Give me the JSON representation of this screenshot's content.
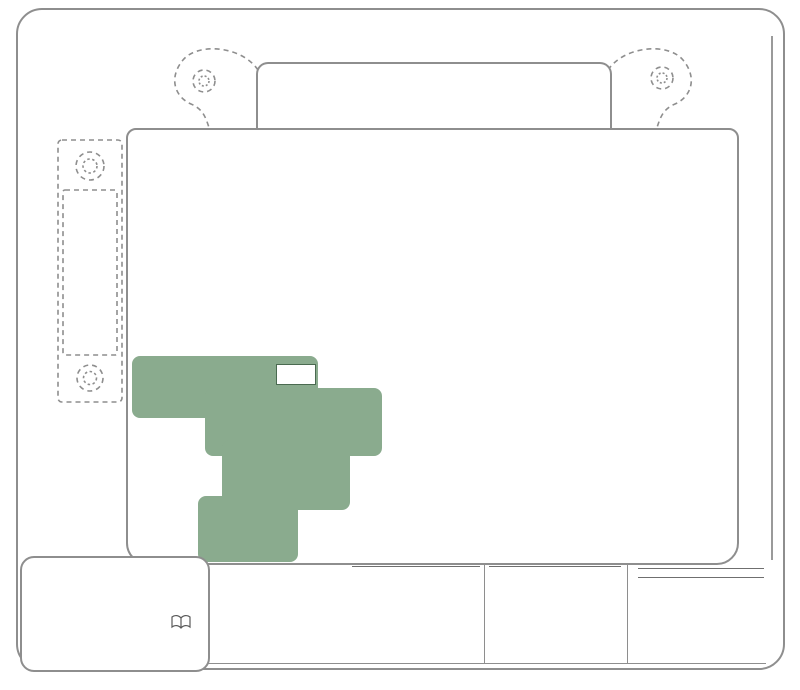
{
  "titles": {
    "en": "Replace cover after servicing.",
    "fr": "Remettre le couvercle en place."
  },
  "labels": {
    "b_plus": "B+",
    "prime": "PRIME",
    "function_line1": "FUNCTION [AMP]",
    "function_line2": "FONCTION [INTENSITÉ]"
  },
  "highlight_color": "#8aab8e",
  "left_block": {
    "lines": [
      "125A",
      "GLOW",
      "PLUG",
      "",
      "OR",
      "",
      "125A",
      "CUST",
      "FEED",
      "",
      "175A",
      "HYBRID"
    ]
  },
  "top_row1": [
    {
      "l1": "STUD",
      "l2": "#1*",
      "l3": "",
      "x": 262,
      "y": 69,
      "w": 54,
      "h": 56
    },
    {
      "l1": "MBEC",
      "l2": "1",
      "l3": "50A",
      "x": 370,
      "y": 69,
      "w": 54,
      "h": 56
    },
    {
      "l1": "BLWR",
      "l2": "",
      "l3": "40A",
      "x": 428,
      "y": 69,
      "w": 54,
      "h": 56
    },
    {
      "l1": "LBEC",
      "l2": "2",
      "l3": "50A",
      "x": 486,
      "y": 69,
      "w": 54,
      "h": 56
    },
    {
      "l1": "STUD",
      "l2": "#2*",
      "l3": "30A MAX",
      "x": 544,
      "y": 69,
      "w": 57,
      "h": 56
    }
  ],
  "top_row2": [
    {
      "l1": "ABS",
      "l2": "",
      "l3": "60A",
      "x": 250,
      "y": 134,
      "w": 56,
      "h": 54
    },
    {
      "l1": "VSES/",
      "l2": "ECAS",
      "l3": "50A",
      "x": 314,
      "y": 134,
      "w": 56,
      "h": 54
    },
    {
      "l1": "IGN",
      "l2": "A",
      "l3": "40A",
      "x": 372,
      "y": 134,
      "w": 56,
      "h": 54
    },
    {
      "l1": "IGN",
      "l2": "B",
      "l3": "40A",
      "x": 488,
      "y": 134,
      "w": 56,
      "h": 54
    },
    {
      "l1": "LBEC",
      "l2": "1",
      "l3": "50A",
      "x": 546,
      "y": 134,
      "w": 56,
      "h": 54
    }
  ],
  "panel": {
    "fuses": [
      {
        "label": "TRL PARK",
        "amp": "15A",
        "x": 140,
        "y": 225,
        "w": 64,
        "h": 24
      },
      {
        "label": "RR PARK",
        "amp": "10A",
        "x": 206,
        "y": 225,
        "w": 62,
        "h": 24
      },
      {
        "label": "LR PARK",
        "amp": "10A",
        "x": 258,
        "y": 225,
        "w": 58,
        "h": 24
      },
      {
        "label": "TBC BATT",
        "amp": "10A",
        "x": 168,
        "y": 256,
        "w": 66,
        "h": 24
      },
      {
        "label": "4WS",
        "amp": "15A",
        "x": 139,
        "y": 281,
        "w": 62,
        "h": 24
      },
      {
        "label": "INTPARK",
        "amp": "10A",
        "x": 512,
        "y": 226,
        "w": 66,
        "h": 24
      },
      {
        "label": "STOP LP",
        "amp": "25A",
        "x": 646,
        "y": 226,
        "w": 68,
        "h": 24
      },
      {
        "label": "SEO B2",
        "amp": "30A",
        "x": 630,
        "y": 251,
        "w": 60,
        "h": 24
      },
      {
        "label": "AUX PWR",
        "amp": "20A",
        "x": 574,
        "y": 279,
        "w": 60,
        "h": 24
      },
      {
        "label": "PCM 1",
        "amp": "15A",
        "x": 252,
        "y": 309,
        "w": 62,
        "h": 24
      },
      {
        "label": "ETC/ECM",
        "amp": "15A",
        "x": 317,
        "y": 309,
        "w": 70,
        "h": 24
      },
      {
        "label": "IGN E",
        "amp": "10A",
        "x": 497,
        "y": 311,
        "w": 60,
        "h": 24
      },
      {
        "label": "RTD",
        "amp": "30A",
        "x": 139,
        "y": 334,
        "w": 62,
        "h": 24
      },
      {
        "label": "TRL B/U",
        "amp": "10A",
        "x": 205,
        "y": 334,
        "w": 64,
        "h": 24
      },
      {
        "label": "B/U LP",
        "amp": "20A",
        "x": 464,
        "y": 336,
        "w": 60,
        "h": 24
      },
      {
        "label": "RR DEFOG",
        "amp": "30A",
        "x": 557,
        "y": 335,
        "w": 72,
        "h": 24
      },
      {
        "label": "AIRBAG",
        "amp": "15A",
        "x": 544,
        "y": 361,
        "w": 62,
        "h": 24
      },
      {
        "label": "SEO IGN",
        "amp": "10A",
        "x": 483,
        "y": 392,
        "w": 60,
        "h": 24
      },
      {
        "label": "TBC IGN1",
        "amp": "10A",
        "x": 544,
        "y": 392,
        "w": 64,
        "h": 24
      },
      {
        "label": "FRT PARK",
        "amp": "10A",
        "x": 227,
        "y": 391,
        "w": 64,
        "h": 25
      },
      {
        "label": "HI HDLP-LT",
        "amp": "10A",
        "x": 132,
        "y": 420,
        "w": 66,
        "h": 25
      },
      {
        "label": "LH HID",
        "amp": "20A",
        "x": 206,
        "y": 419,
        "w": 58,
        "h": 25
      },
      {
        "label": "DRL",
        "amp": "10A",
        "x": 376,
        "y": 419,
        "w": 54,
        "h": 24
      },
      {
        "label": "RVC",
        "amp": "10A",
        "x": 431,
        "y": 419,
        "w": 52,
        "h": 24
      },
      {
        "label": "IPC/DIC",
        "amp": "10A",
        "x": 485,
        "y": 418,
        "w": 56,
        "h": 24
      },
      {
        "label": "HVAC/ECAS",
        "amp": "10A",
        "x": 543,
        "y": 417,
        "w": 62,
        "h": 24
      },
      {
        "label": "CIG LTR",
        "amp": "15A",
        "x": 629,
        "y": 419,
        "w": 58,
        "h": 24
      },
      {
        "label": "HI HDLP-RT",
        "amp": "10A",
        "x": 132,
        "y": 451,
        "w": 66,
        "h": 25
      },
      {
        "label": "A/C COMP",
        "amp": "10A",
        "x": 428,
        "y": 447,
        "w": 58,
        "h": 23
      },
      {
        "label": "TCMB",
        "amp": "10A",
        "x": 488,
        "y": 447,
        "w": 54,
        "h": 23
      },
      {
        "label": "RR WPR",
        "amp": "25A",
        "x": 544,
        "y": 448,
        "w": 56,
        "h": 23
      },
      {
        "label": "RADIO",
        "amp": "15A",
        "x": 603,
        "y": 448,
        "w": 54,
        "h": 23
      },
      {
        "label": "SEO B1",
        "amp": "15A",
        "x": 660,
        "y": 448,
        "w": 56,
        "h": 23
      },
      {
        "label": "LO HDLP-LT",
        "amp": "10A",
        "x": 132,
        "y": 481,
        "w": 66,
        "h": 25
      },
      {
        "label": "BTSI",
        "amp": "10A",
        "x": 428,
        "y": 475,
        "w": 54,
        "h": 23
      },
      {
        "label": "CRNK",
        "amp": "10A",
        "x": 488,
        "y": 475,
        "w": 54,
        "h": 23
      },
      {
        "label": "LO HDLP-RT",
        "amp": "10A",
        "x": 132,
        "y": 511,
        "w": 66,
        "h": 25
      },
      {
        "label": "FOG LP",
        "amp": "15A",
        "x": 288,
        "y": 504,
        "w": 58,
        "h": 24
      },
      {
        "label": "W/S WASH",
        "amp": "15A",
        "x": 514,
        "y": 501,
        "w": 64,
        "h": 24
      },
      {
        "label": "INFO",
        "amp": "15A",
        "x": 601,
        "y": 501,
        "w": 58,
        "h": 24
      },
      {
        "label": "RADIO AMP",
        "amp": "30A",
        "x": 660,
        "y": 501,
        "w": 64,
        "h": 24
      },
      {
        "label": "RH HID",
        "amp": "20A",
        "x": 134,
        "y": 540,
        "w": 64,
        "h": 25
      },
      {
        "label": "HORN",
        "amp": "15A",
        "x": 288,
        "y": 534,
        "w": 58,
        "h": 24
      },
      {
        "label": "EAP",
        "amp": "15A",
        "x": 514,
        "y": 531,
        "w": 64,
        "h": 24
      },
      {
        "label": "TREC",
        "amp": "30A",
        "x": 601,
        "y": 531,
        "w": 58,
        "h": 24
      },
      {
        "label": "SBA",
        "amp": "15A",
        "x": 660,
        "y": 531,
        "w": 58,
        "h": 24
      }
    ],
    "relays": [
      {
        "label": "PARK LP",
        "pins": [
          "86",
          "30",
          "87",
          "85"
        ],
        "x": 318,
        "y": 225,
        "w": 84,
        "h": 64,
        "green": false
      },
      {
        "label": "STRTR",
        "pins": [
          "86",
          "30",
          "87",
          "85"
        ],
        "x": 432,
        "y": 225,
        "w": 84,
        "h": 64,
        "green": false
      },
      {
        "label": "F/PMP",
        "pins": [
          "86",
          "30",
          "87",
          "85"
        ],
        "x": 318,
        "y": 336,
        "w": 88,
        "h": 57,
        "green": false
      },
      {
        "label": "HDLP HI",
        "pins": [
          "86",
          "30",
          "87",
          "85"
        ],
        "x": 140,
        "y": 362,
        "w": 84,
        "h": 51,
        "green": true
      },
      {
        "label": "DRL",
        "pins": [
          "86",
          "30",
          "87",
          "85"
        ],
        "x": 288,
        "y": 390,
        "w": 88,
        "h": 58,
        "green": true
      },
      {
        "label": "HDLP-LOW",
        "pins": [
          "86",
          "30",
          "87",
          "85"
        ],
        "x": 255,
        "y": 444,
        "w": 90,
        "h": 57,
        "green": true
      },
      {
        "label": "A/C COMP",
        "pins": [
          "86",
          "30",
          "87",
          "85"
        ],
        "x": 348,
        "y": 443,
        "w": 82,
        "h": 51,
        "green": false
      },
      {
        "label": "FOG LP",
        "pins": [
          "86",
          "30",
          "87",
          "85"
        ],
        "x": 204,
        "y": 501,
        "w": 88,
        "h": 58,
        "green": true
      },
      {
        "label": "HORN",
        "pins": [
          "86",
          "30",
          "87",
          "85"
        ],
        "x": 346,
        "y": 501,
        "w": 84,
        "h": 56,
        "green": false
      },
      {
        "label": "W/S WASH",
        "pins": [
          "86",
          "30",
          "87",
          "85"
        ],
        "x": 432,
        "y": 499,
        "w": 82,
        "h": 56,
        "green": false
      }
    ],
    "big_relay": {
      "pins": [
        "85",
        "87",
        "30",
        "86"
      ],
      "glyph": "❺",
      "star": "*",
      "x": 632,
      "y": 278,
      "w": 98,
      "h": 92
    },
    "markers": [
      {
        "glyph": "❽",
        "star": "*",
        "x": 576,
        "y": 250,
        "w": 50,
        "h": 22
      },
      {
        "glyph": "❼",
        "star": "*",
        "x": 518,
        "y": 279,
        "w": 52,
        "h": 22
      },
      {
        "glyph": "❷",
        "star": "*",
        "x": 388,
        "y": 309,
        "w": 52,
        "h": 25
      },
      {
        "glyph": "❶",
        "star": "*",
        "x": 446,
        "y": 309,
        "w": 52,
        "h": 25
      },
      {
        "glyph": "❻",
        "star": "*",
        "x": 256,
        "y": 336,
        "w": 52,
        "h": 25
      },
      {
        "glyph": "❸",
        "star": "*",
        "x": 412,
        "y": 336,
        "w": 50,
        "h": 25
      },
      {
        "glyph": "❹",
        "star": "*",
        "x": 464,
        "y": 361,
        "w": 54,
        "h": 25
      }
    ],
    "breakers": [
      {
        "x": 214,
        "y": 280,
        "w": 52,
        "h": 52,
        "green": false
      },
      {
        "x": 408,
        "y": 360,
        "w": 52,
        "h": 54,
        "green": false
      },
      {
        "x": 608,
        "y": 361,
        "w": 50,
        "h": 48,
        "green": false
      },
      {
        "x": 226,
        "y": 444,
        "w": 56,
        "h": 57,
        "green": true
      }
    ]
  },
  "legend": {
    "gas": {
      "title1": "GAS",
      "title2": "ESSENCE",
      "items": [
        {
          "n": "❶",
          "label": "INJ 2",
          "amp": "[15A]"
        },
        {
          "n": "❷",
          "label": "INJ 1",
          "amp": "[15A]"
        },
        {
          "n": "❸",
          "label": "02A",
          "amp": "[15A]"
        },
        {
          "n": "❹",
          "label": "02B",
          "amp": "[15A]"
        },
        {
          "n": "❺",
          "label": "IGN 1",
          "amp": ""
        },
        {
          "n": "❻",
          "label": "PCMB",
          "amp": "[20A]"
        }
      ]
    },
    "diesel": {
      "title1": "DIESEL",
      "title2": "DIESEL",
      "items": [
        {
          "n": "❶",
          "label": "ECM",
          "amp": "[25A]"
        },
        {
          "n": "❷",
          "label": "ACTUATOR",
          "amp": "[15A]"
        },
        {
          "n": "❸",
          "label": "FUEL HTR",
          "amp": "[15A]"
        },
        {
          "n": "❹",
          "label": "ECM 1",
          "amp": "[15A]"
        },
        {
          "n": "❺",
          "label": "ECM",
          "amp": ""
        },
        {
          "n": "❻",
          "label": "ECMB",
          "amp": "[20A]"
        }
      ]
    },
    "right": {
      "title1": "EXCEPT H2",
      "title2": "SAUF H2",
      "items": [
        {
          "n": "❼",
          "label": "RR HVAC",
          "amp": "[30A]"
        },
        {
          "n": "❽",
          "label": "S/ROOF",
          "amp": "[25A]"
        }
      ],
      "h2_title": "H2",
      "h2_items": [
        {
          "n": "❼",
          "label": "S/ROOF",
          "amp": "[30A]"
        },
        {
          "n": "❽",
          "label": "",
          "amp": "[    ]"
        }
      ]
    }
  },
  "notes": {
    "star": "*",
    "en": "NOTE: The function and amperage of these fuses are different, depending on vehicle content. See Owner's Manual for functions of studs #1 and #2.",
    "fr": "REMARQUE: La fonction et l'intensité de ces fusibles diffèrent suivant l'équipement du véhicule. Voir le Guide du propriétaire pour les fonctions des plots 1 et 2."
  }
}
